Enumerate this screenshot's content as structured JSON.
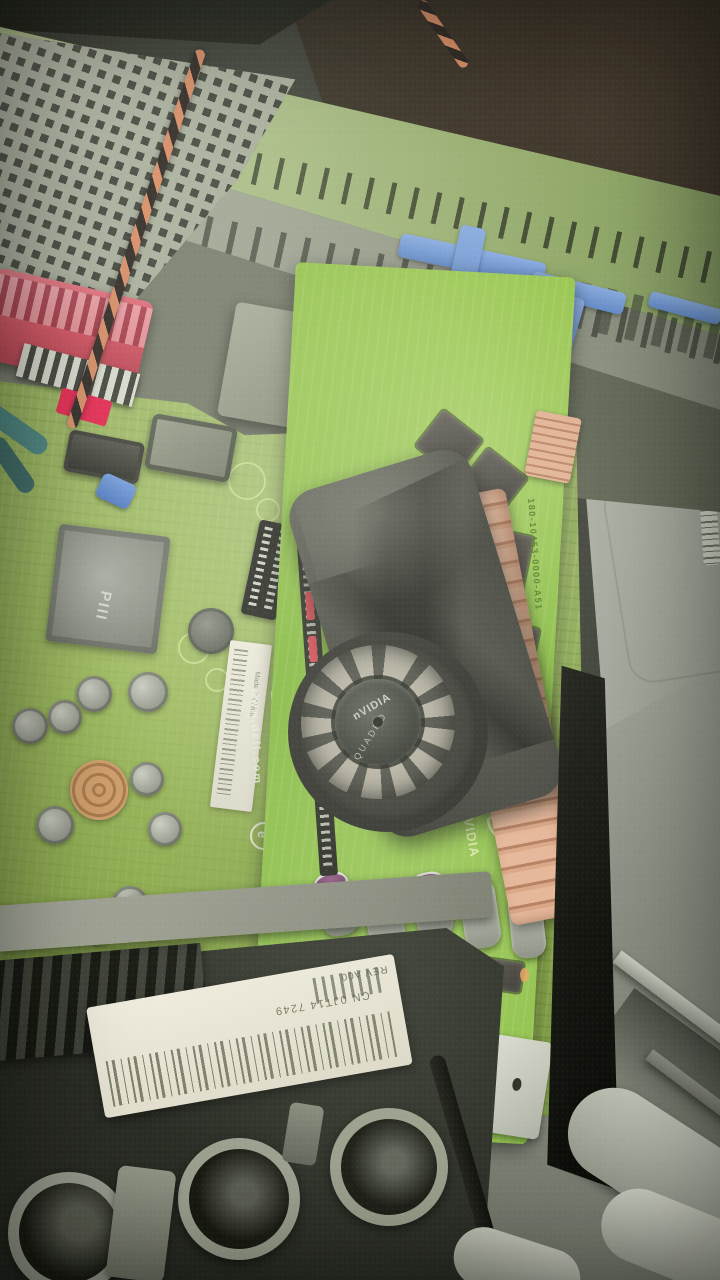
{
  "photo_subject": "open-desktop-pc-case-with-dell-motherboard-and-nvidia-quadro-gpu",
  "labels": {
    "dell_logo": "DELL",
    "dell_url": "www.dell.com",
    "made_in_china": "Made in China",
    "e_mark": "e",
    "chipset_marking": "PIII",
    "fan_hub_brand": "nVIDIA",
    "fan_hub_model": "QUADRO",
    "pcb_silkscreen_brand": "nVIDIA",
    "gpu_part_number": "180-10453-0000-A51",
    "shroud_label_rev": "REV A00",
    "shroud_label_cn": "CN 0JT14 7249"
  },
  "colors": {
    "motherboard_green": "#8cab4e",
    "gpu_pcb_green": "#82bb38",
    "copper_heatsink": "#e0ae90",
    "fan_shroud_dark": "#33342e",
    "case_metal_olive": "#9db273",
    "case_metal_gray": "#9aa08e",
    "psu_gray": "#bcc0b4",
    "ide_connector_red": "#d4505f",
    "retention_clip_blue": "#6d96d8",
    "label_white": "#ece9dc",
    "shadow_black": "#131410"
  }
}
